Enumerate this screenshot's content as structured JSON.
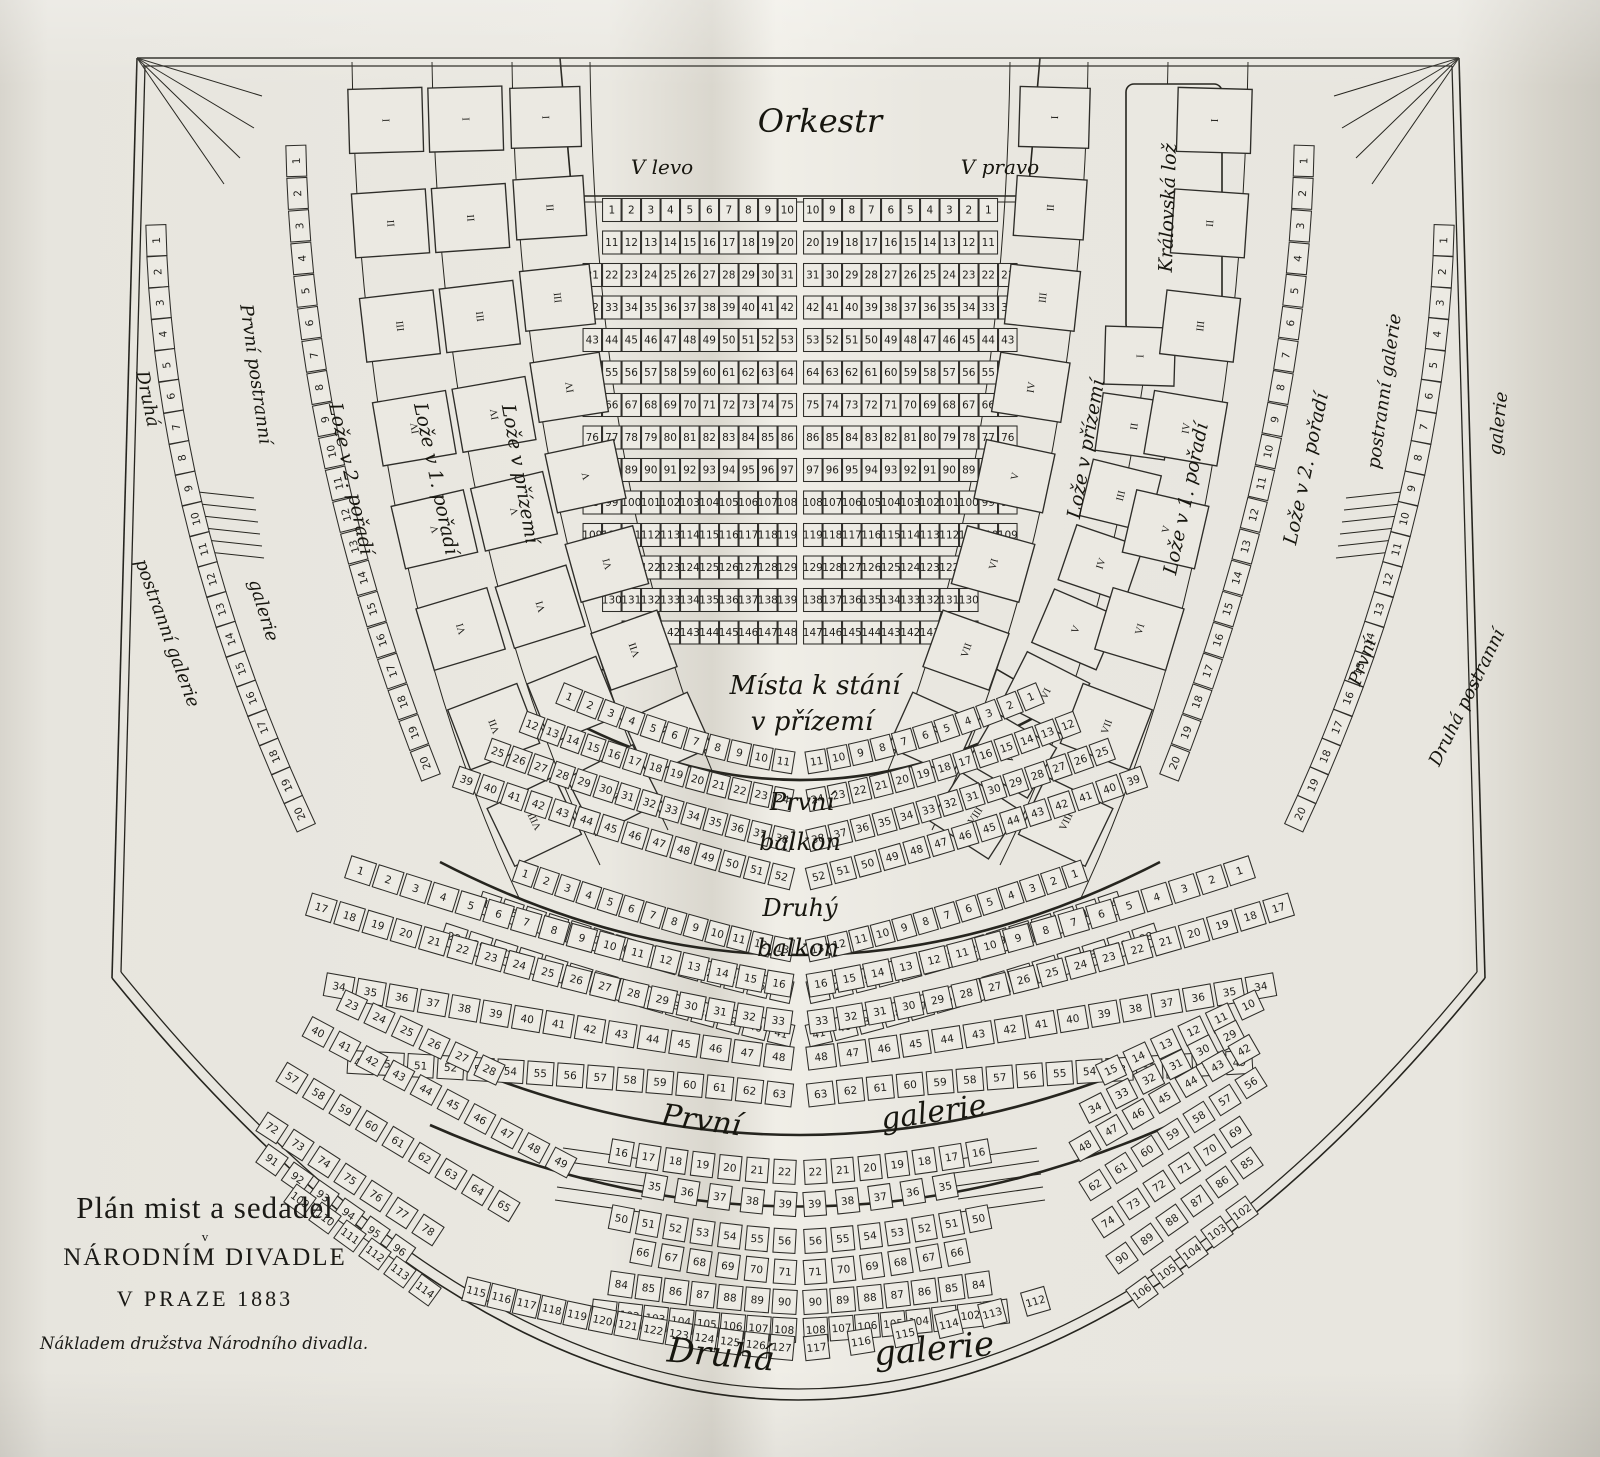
{
  "title_block": {
    "line1": "Plán mist a sedadel",
    "line2_small": "v",
    "line2": "NÁRODNÍM DIVADLE",
    "line3": "V PRAZE 1883",
    "imprint": "Nákladem družstva Národního divadla."
  },
  "labels": {
    "orkestr": "Orkestr",
    "v_levo": "V levo",
    "v_pravo": "V pravo",
    "mista_1": "Místa k stání",
    "mista_2": "v přízemí",
    "balkon1_1": "První",
    "balkon1_2": "balkon",
    "balkon2_1": "Druhý",
    "balkon2_2": "balkon",
    "galerie1_1": "První",
    "galerie1_2": "galerie",
    "galerie2_1": "Druhá",
    "galerie2_2": "galerie",
    "loze_prizemi": "Lože v přízemí",
    "loze_1": "Lože v 1. pořadí",
    "loze_2": "Lože v 2. pořadí",
    "kralovska": "Královská lož",
    "pp_1": "První postranní",
    "pp_2": "galerie",
    "dp_1": "Druhá",
    "dp_2": "postranní galerie",
    "rp_1": "postranní galerie",
    "rp_2": "První",
    "rd_1": "galerie",
    "rd_2": "Druhá postranní"
  },
  "bands": [
    {
      "name": "parterre-r1-left",
      "x": 611.75,
      "y": 210,
      "dx": 19.5,
      "seq": [
        [
          1,
          10
        ]
      ],
      "cls": "pt",
      "w": 18.5,
      "h": 23
    },
    {
      "name": "parterre-r1-right",
      "x": 812.75,
      "y": 210,
      "dx": 19.5,
      "seq": [
        [
          10,
          1
        ]
      ],
      "cls": "pt",
      "w": 18.5,
      "h": 23
    },
    {
      "name": "parterre-r2-left",
      "x": 611.75,
      "y": 242.5,
      "dx": 19.5,
      "seq": [
        [
          11,
          20
        ]
      ],
      "cls": "pt",
      "w": 18.5,
      "h": 23
    },
    {
      "name": "parterre-r2-right",
      "x": 812.75,
      "y": 242.5,
      "dx": 19.5,
      "seq": [
        [
          20,
          11
        ]
      ],
      "cls": "pt",
      "w": 18.5,
      "h": 23
    },
    {
      "name": "parterre-r3-left",
      "x": 592.25,
      "y": 275,
      "dx": 19.5,
      "seq": [
        [
          21,
          31
        ]
      ],
      "cls": "pt",
      "w": 18.5,
      "h": 23
    },
    {
      "name": "parterre-r3-right",
      "x": 812.75,
      "y": 275,
      "dx": 19.5,
      "seq": [
        [
          31,
          21
        ]
      ],
      "cls": "pt",
      "w": 18.5,
      "h": 23
    },
    {
      "name": "parterre-r4-left",
      "x": 592.25,
      "y": 307.5,
      "dx": 19.5,
      "seq": [
        [
          32,
          42
        ]
      ],
      "cls": "pt",
      "w": 18.5,
      "h": 23
    },
    {
      "name": "parterre-r4-right",
      "x": 812.75,
      "y": 307.5,
      "dx": 19.5,
      "seq": [
        [
          42,
          32
        ]
      ],
      "cls": "pt",
      "w": 18.5,
      "h": 23
    },
    {
      "name": "parterre-r5-left",
      "x": 592.25,
      "y": 340,
      "dx": 19.5,
      "seq": [
        [
          43,
          53
        ]
      ],
      "cls": "pt",
      "w": 18.5,
      "h": 23
    },
    {
      "name": "parterre-r5-right",
      "x": 812.75,
      "y": 340,
      "dx": 19.5,
      "seq": [
        [
          53,
          43
        ]
      ],
      "cls": "pt",
      "w": 18.5,
      "h": 23
    },
    {
      "name": "parterre-r6-left",
      "x": 592.25,
      "y": 372.5,
      "dx": 19.5,
      "seq": [
        [
          54,
          64
        ]
      ],
      "cls": "pt",
      "w": 18.5,
      "h": 23
    },
    {
      "name": "parterre-r6-right",
      "x": 812.75,
      "y": 372.5,
      "dx": 19.5,
      "seq": [
        [
          64,
          54
        ]
      ],
      "cls": "pt",
      "w": 18.5,
      "h": 23
    },
    {
      "name": "parterre-r7-left",
      "x": 592.25,
      "y": 405,
      "dx": 19.5,
      "seq": [
        [
          65,
          75
        ]
      ],
      "cls": "pt",
      "w": 18.5,
      "h": 23
    },
    {
      "name": "parterre-r7-right",
      "x": 812.75,
      "y": 405,
      "dx": 19.5,
      "seq": [
        [
          75,
          65
        ]
      ],
      "cls": "pt",
      "w": 18.5,
      "h": 23
    },
    {
      "name": "parterre-r8-left",
      "x": 592.25,
      "y": 437.5,
      "dx": 19.5,
      "seq": [
        [
          76,
          86
        ]
      ],
      "cls": "pt",
      "w": 18.5,
      "h": 23
    },
    {
      "name": "parterre-r8-right",
      "x": 812.75,
      "y": 437.5,
      "dx": 19.5,
      "seq": [
        [
          86,
          76
        ]
      ],
      "cls": "pt",
      "w": 18.5,
      "h": 23
    },
    {
      "name": "parterre-r9-left",
      "x": 592.25,
      "y": 470,
      "dx": 19.5,
      "seq": [
        [
          87,
          97
        ]
      ],
      "cls": "pt",
      "w": 18.5,
      "h": 23
    },
    {
      "name": "parterre-r9-right",
      "x": 812.75,
      "y": 470,
      "dx": 19.5,
      "seq": [
        [
          97,
          87
        ]
      ],
      "cls": "pt",
      "w": 18.5,
      "h": 23
    },
    {
      "name": "parterre-r10-left",
      "x": 592.25,
      "y": 502.5,
      "dx": 19.5,
      "seq": [
        [
          98,
          108
        ]
      ],
      "cls": "pt",
      "w": 18.5,
      "h": 23
    },
    {
      "name": "parterre-r10-right",
      "x": 812.75,
      "y": 502.5,
      "dx": 19.5,
      "seq": [
        [
          108,
          98
        ]
      ],
      "cls": "pt",
      "w": 18.5,
      "h": 23
    },
    {
      "name": "parterre-r11-left",
      "x": 592.25,
      "y": 535,
      "dx": 19.5,
      "seq": [
        [
          109,
          119
        ]
      ],
      "cls": "pt",
      "w": 18.5,
      "h": 23
    },
    {
      "name": "parterre-r11-right",
      "x": 812.75,
      "y": 535,
      "dx": 19.5,
      "seq": [
        [
          119,
          109
        ]
      ],
      "cls": "pt",
      "w": 18.5,
      "h": 23
    },
    {
      "name": "parterre-r12-left",
      "x": 611.75,
      "y": 567.5,
      "dx": 19.5,
      "seq": [
        [
          120,
          129
        ]
      ],
      "cls": "pt",
      "w": 18.5,
      "h": 23
    },
    {
      "name": "parterre-r12-right",
      "x": 812.75,
      "y": 567.5,
      "dx": 19.5,
      "seq": [
        [
          129,
          120
        ]
      ],
      "cls": "pt",
      "w": 18.5,
      "h": 23
    },
    {
      "name": "parterre-r13-left",
      "x": 611.75,
      "y": 600,
      "dx": 19.5,
      "seq": [
        [
          130,
          139
        ]
      ],
      "cls": "pt",
      "w": 18.5,
      "h": 23
    },
    {
      "name": "parterre-r13-right",
      "x": 812.75,
      "y": 600,
      "dx": 19.5,
      "seq": [
        [
          138,
          130
        ]
      ],
      "cls": "pt",
      "w": 18.5,
      "h": 23
    },
    {
      "name": "parterre-r14-left",
      "x": 631.25,
      "y": 632.5,
      "dx": 19.5,
      "seq": [
        [
          140,
          148
        ]
      ],
      "cls": "pt",
      "w": 18.5,
      "h": 23
    },
    {
      "name": "parterre-r14-right",
      "x": 812.75,
      "y": 632.5,
      "dx": 19.5,
      "seq": [
        [
          147,
          139
        ]
      ],
      "cls": "pt",
      "w": 18.5,
      "h": 23
    },
    {
      "name": "loze-2-left",
      "path": "pL2",
      "nums": [
        "I",
        "II",
        "III",
        "IV",
        "V",
        "VI",
        "VII",
        "VIII"
      ],
      "cls": "box",
      "w": 64,
      "h": 74,
      "fs": 20,
      "flip": true,
      "t0": 0.04,
      "t1": 0.93
    },
    {
      "name": "loze-1-left",
      "path": "pL1",
      "nums": [
        "I",
        "II",
        "III",
        "IV",
        "V",
        "VI",
        "VII",
        "VIII"
      ],
      "cls": "box",
      "w": 64,
      "h": 74,
      "fs": 20,
      "flip": true,
      "t0": 0.04,
      "t1": 0.93
    },
    {
      "name": "loze-prizemi-left",
      "path": "pL0",
      "nums": [
        "I",
        "II",
        "III",
        "IV",
        "V",
        "VI",
        "VII",
        "VIII"
      ],
      "cls": "box",
      "w": 60,
      "h": 70,
      "fs": 20,
      "flip": true,
      "t0": 0.04,
      "t1": 0.9
    },
    {
      "name": "loze-prizemi-right",
      "path": "pR0",
      "nums": [
        "I",
        "II",
        "III",
        "IV",
        "V",
        "VI",
        "VII",
        "VIII"
      ],
      "cls": "box",
      "w": 60,
      "h": 70,
      "fs": 20,
      "flip": true,
      "t0": 0.04,
      "t1": 0.9
    },
    {
      "name": "loze-1-right",
      "path": "pR1",
      "nums": [
        "I",
        "II",
        "III",
        "IV",
        "V",
        "VI",
        "VII",
        "VIII"
      ],
      "cls": "box",
      "w": 58,
      "h": 70,
      "fs": 20,
      "flip": true,
      "t0": 0.03,
      "t1": 0.95
    },
    {
      "name": "loze-2-right",
      "path": "pR2",
      "nums": [
        "I",
        "II",
        "III",
        "IV",
        "V",
        "VI",
        "VII",
        "VIII"
      ],
      "cls": "box",
      "w": 64,
      "h": 74,
      "fs": 20,
      "flip": true,
      "t0": 0.04,
      "t1": 0.93
    },
    {
      "name": "side-gal-1-left",
      "path": "pSGLi",
      "seq": [
        [
          1,
          20
        ]
      ],
      "cls": "sg",
      "w": 31,
      "h": 20,
      "fs": 9.5,
      "flip": true
    },
    {
      "name": "side-gal-2-left",
      "path": "pSGLo",
      "seq": [
        [
          1,
          20
        ]
      ],
      "cls": "sg",
      "w": 31,
      "h": 20,
      "fs": 9.5,
      "flip": true
    },
    {
      "name": "side-gal-1-right",
      "path": "pSGRi",
      "seq": [
        [
          1,
          20
        ]
      ],
      "cls": "sg",
      "w": 31,
      "h": 20,
      "fs": 9.5,
      "flip": true
    },
    {
      "name": "side-gal-2-right",
      "path": "pSGRo",
      "seq": [
        [
          1,
          20
        ]
      ],
      "cls": "sg",
      "w": 31,
      "h": 20,
      "fs": 9.5,
      "flip": true
    },
    {
      "name": "balkon1-l1",
      "path": "pB1L1",
      "seq": [
        [
          1,
          11
        ]
      ],
      "cls": "b",
      "w": 20,
      "h": 22
    },
    {
      "name": "balkon1-l2",
      "path": "pB1L2",
      "seq": [
        [
          12,
          24
        ]
      ],
      "cls": "b",
      "w": 19,
      "h": 22
    },
    {
      "name": "balkon1-l3",
      "path": "pB1L3",
      "seq": [
        [
          25,
          38
        ]
      ],
      "cls": "b",
      "w": 20,
      "h": 22
    },
    {
      "name": "balkon1-l4",
      "path": "pB1L4",
      "seq": [
        [
          39,
          52
        ]
      ],
      "cls": "b",
      "w": 22,
      "h": 22
    },
    {
      "name": "balkon1-r1",
      "path": "pB1R1",
      "seq": [
        [
          11,
          1
        ]
      ],
      "cls": "b",
      "w": 20,
      "h": 22
    },
    {
      "name": "balkon1-r2",
      "path": "pB1R2",
      "seq": [
        [
          24,
          12
        ]
      ],
      "cls": "b",
      "w": 19,
      "h": 22
    },
    {
      "name": "balkon1-r3",
      "path": "pB1R3",
      "seq": [
        [
          38,
          25
        ]
      ],
      "cls": "b",
      "w": 20,
      "h": 22
    },
    {
      "name": "balkon1-r4",
      "path": "pB1R4",
      "seq": [
        [
          52,
          39
        ]
      ],
      "cls": "b",
      "w": 22,
      "h": 22
    },
    {
      "name": "balkon2-l1",
      "path": "pB2L1",
      "seq": [
        [
          1,
          13
        ]
      ],
      "cls": "b",
      "w": 20,
      "h": 22
    },
    {
      "name": "balkon2-l2",
      "path": "pB2L2",
      "seq": [
        [
          14,
          27
        ]
      ],
      "cls": "b",
      "w": 20,
      "h": 22
    },
    {
      "name": "balkon2-l3",
      "path": "pB2L3",
      "seq": [
        [
          28,
          41
        ]
      ],
      "cls": "b",
      "w": 23,
      "h": 22
    },
    {
      "name": "balkon2-r1",
      "path": "pB2R1",
      "seq": [
        [
          13,
          1
        ]
      ],
      "cls": "b",
      "w": 20,
      "h": 22
    },
    {
      "name": "balkon2-r2",
      "path": "pB2R2",
      "seq": [
        [
          27,
          14
        ]
      ],
      "cls": "b",
      "w": 20,
      "h": 22
    },
    {
      "name": "balkon2-r3",
      "path": "pB2R3",
      "seq": [
        [
          41,
          28
        ]
      ],
      "cls": "b",
      "w": 23,
      "h": 22
    },
    {
      "name": "galerie1-l1",
      "path": "pG1L1",
      "seq": [
        [
          1,
          16
        ]
      ],
      "cls": "b",
      "w": 26,
      "h": 23
    },
    {
      "name": "galerie1-l2",
      "path": "pG1L2",
      "seq": [
        [
          17,
          33
        ]
      ],
      "cls": "b",
      "w": 26,
      "h": 23
    },
    {
      "name": "galerie1-l3",
      "path": "pG1L3",
      "seq": [
        [
          34,
          48
        ]
      ],
      "cls": "b",
      "w": 28,
      "h": 23
    },
    {
      "name": "galerie1-l4",
      "path": "pG1L4",
      "seq": [
        [
          49,
          63
        ]
      ],
      "cls": "b",
      "w": 26,
      "h": 23
    },
    {
      "name": "galerie1-r1",
      "path": "pG1R1",
      "seq": [
        [
          16,
          1
        ]
      ],
      "cls": "b",
      "w": 26,
      "h": 23
    },
    {
      "name": "galerie1-r2",
      "path": "pG1R2",
      "seq": [
        [
          33,
          17
        ]
      ],
      "cls": "b",
      "w": 26,
      "h": 23
    },
    {
      "name": "galerie1-r3",
      "path": "pG1R3",
      "seq": [
        [
          48,
          34
        ]
      ],
      "cls": "b",
      "w": 28,
      "h": 23
    },
    {
      "name": "galerie1-r4",
      "path": "pG1R4",
      "seq": [
        [
          63,
          49
        ]
      ],
      "cls": "b",
      "w": 26,
      "h": 23
    },
    {
      "name": "galerie2-l1",
      "path": "pG2L1",
      "seq": [
        [
          16,
          22
        ]
      ],
      "cls": "b",
      "w": 22,
      "h": 24
    },
    {
      "name": "galerie2-l2",
      "path": "pG2L2",
      "seq": [
        [
          35,
          39
        ]
      ],
      "cls": "b",
      "w": 22,
      "h": 24
    },
    {
      "name": "galerie2-l3",
      "path": "pG2L3",
      "seq": [
        [
          50,
          56
        ]
      ],
      "cls": "b",
      "w": 22,
      "h": 24
    },
    {
      "name": "galerie2-l4",
      "path": "pG2L4",
      "seq": [
        [
          66,
          71
        ]
      ],
      "cls": "b",
      "w": 22,
      "h": 24
    },
    {
      "name": "galerie2-l5",
      "path": "pG2L5",
      "seq": [
        [
          84,
          90
        ]
      ],
      "cls": "b",
      "w": 24,
      "h": 24
    },
    {
      "name": "galerie2-l6",
      "path": "pG2L6",
      "seq": [
        [
          101,
          108
        ]
      ],
      "cls": "b",
      "w": 24,
      "h": 24
    },
    {
      "name": "galerie2-l7",
      "path": "pG2L7",
      "seq": [
        [
          115,
          127
        ]
      ],
      "cls": "b",
      "w": 24,
      "h": 24
    },
    {
      "name": "galerie2-r1",
      "path": "pG2R1",
      "seq": [
        [
          22,
          16
        ]
      ],
      "cls": "b",
      "w": 22,
      "h": 24
    },
    {
      "name": "galerie2-r2",
      "path": "pG2R2",
      "seq": [
        [
          39,
          35
        ]
      ],
      "cls": "b",
      "w": 22,
      "h": 24
    },
    {
      "name": "galerie2-r3",
      "path": "pG2R3",
      "seq": [
        [
          56,
          50
        ]
      ],
      "cls": "b",
      "w": 22,
      "h": 24
    },
    {
      "name": "galerie2-r4",
      "path": "pG2R4",
      "seq": [
        [
          71,
          66
        ]
      ],
      "cls": "b",
      "w": 22,
      "h": 24
    },
    {
      "name": "galerie2-r5",
      "path": "pG2R5",
      "seq": [
        [
          90,
          84
        ]
      ],
      "cls": "b",
      "w": 24,
      "h": 24
    },
    {
      "name": "galerie2-r6",
      "path": "pG2R6",
      "seq": [
        [
          108,
          101
        ]
      ],
      "cls": "b",
      "w": 24,
      "h": 24
    },
    {
      "name": "galerie2-r7",
      "path": "pG2R7",
      "seq": [
        [
          117,
          112
        ]
      ],
      "cls": "b",
      "w": 24,
      "h": 24
    },
    {
      "name": "galerie2-wing-l1",
      "x": 352,
      "y": 1005,
      "dx": 27.5,
      "dy": 13,
      "rot": 25,
      "seq": [
        [
          23,
          28
        ]
      ],
      "cls": "b",
      "w": 24,
      "h": 22
    },
    {
      "name": "galerie2-wing-l2",
      "x": 318,
      "y": 1032,
      "dx": 27,
      "dy": 14.5,
      "rot": 28,
      "seq": [
        [
          40,
          49
        ]
      ],
      "cls": "b",
      "w": 24,
      "h": 22
    },
    {
      "name": "galerie2-wing-l3",
      "x": 292,
      "y": 1078,
      "dx": 26.5,
      "dy": 16,
      "rot": 31,
      "seq": [
        [
          57,
          65
        ]
      ],
      "cls": "b",
      "w": 24,
      "h": 22
    },
    {
      "name": "galerie2-wing-l4",
      "x": 272,
      "y": 1128,
      "dx": 26,
      "dy": 17,
      "rot": 33,
      "seq": [
        [
          72,
          78
        ]
      ],
      "cls": "b",
      "w": 24,
      "h": 22
    },
    {
      "name": "galerie2-wing-l5",
      "x": 272,
      "y": 1160,
      "dx": 25.5,
      "dy": 18,
      "rot": 35,
      "seq": [
        [
          91,
          96
        ]
      ],
      "cls": "b",
      "w": 24,
      "h": 22
    },
    {
      "name": "galerie2-wing-l6",
      "x": 300,
      "y": 1200,
      "dx": 25,
      "dy": 18,
      "rot": 36,
      "seq": [
        [
          109,
          114
        ]
      ],
      "cls": "b",
      "w": 24,
      "h": 22
    },
    {
      "name": "galerie2-wing-r1",
      "x": 1111,
      "y": 1070,
      "dx": 27.5,
      "dy": -13,
      "rot": -25,
      "seq": [
        [
          15,
          10
        ]
      ],
      "cls": "b",
      "w": 24,
      "h": 22
    },
    {
      "name": "galerie2-wing-r2",
      "x": 1095,
      "y": 1108,
      "dx": 27,
      "dy": -14.5,
      "rot": -27,
      "seq": [
        [
          34,
          29
        ]
      ],
      "cls": "b",
      "w": 24,
      "h": 22
    },
    {
      "name": "galerie2-wing-r3",
      "x": 1085,
      "y": 1146,
      "dx": 26.5,
      "dy": -16,
      "rot": -30,
      "seq": [
        [
          48,
          42
        ]
      ],
      "cls": "b",
      "w": 24,
      "h": 22
    },
    {
      "name": "galerie2-wing-r4",
      "x": 1095,
      "y": 1185,
      "dx": 26,
      "dy": -17,
      "rot": -32,
      "seq": [
        [
          62,
          56
        ]
      ],
      "cls": "b",
      "w": 24,
      "h": 22
    },
    {
      "name": "galerie2-wing-r5",
      "x": 1108,
      "y": 1222,
      "dx": 25.5,
      "dy": -18,
      "rot": -33,
      "seq": [
        [
          74,
          69
        ]
      ],
      "cls": "b",
      "w": 24,
      "h": 22
    },
    {
      "name": "galerie2-wing-r6",
      "x": 1122,
      "y": 1258,
      "dx": 25,
      "dy": -19,
      "rot": -35,
      "seq": [
        [
          90,
          85
        ]
      ],
      "cls": "b",
      "w": 24,
      "h": 22
    },
    {
      "name": "galerie2-wing-r7",
      "x": 1142,
      "y": 1292,
      "dx": 25,
      "dy": -20,
      "rot": -36,
      "seq": [
        [
          106,
          102
        ]
      ],
      "cls": "b",
      "w": 24,
      "h": 22
    }
  ]
}
